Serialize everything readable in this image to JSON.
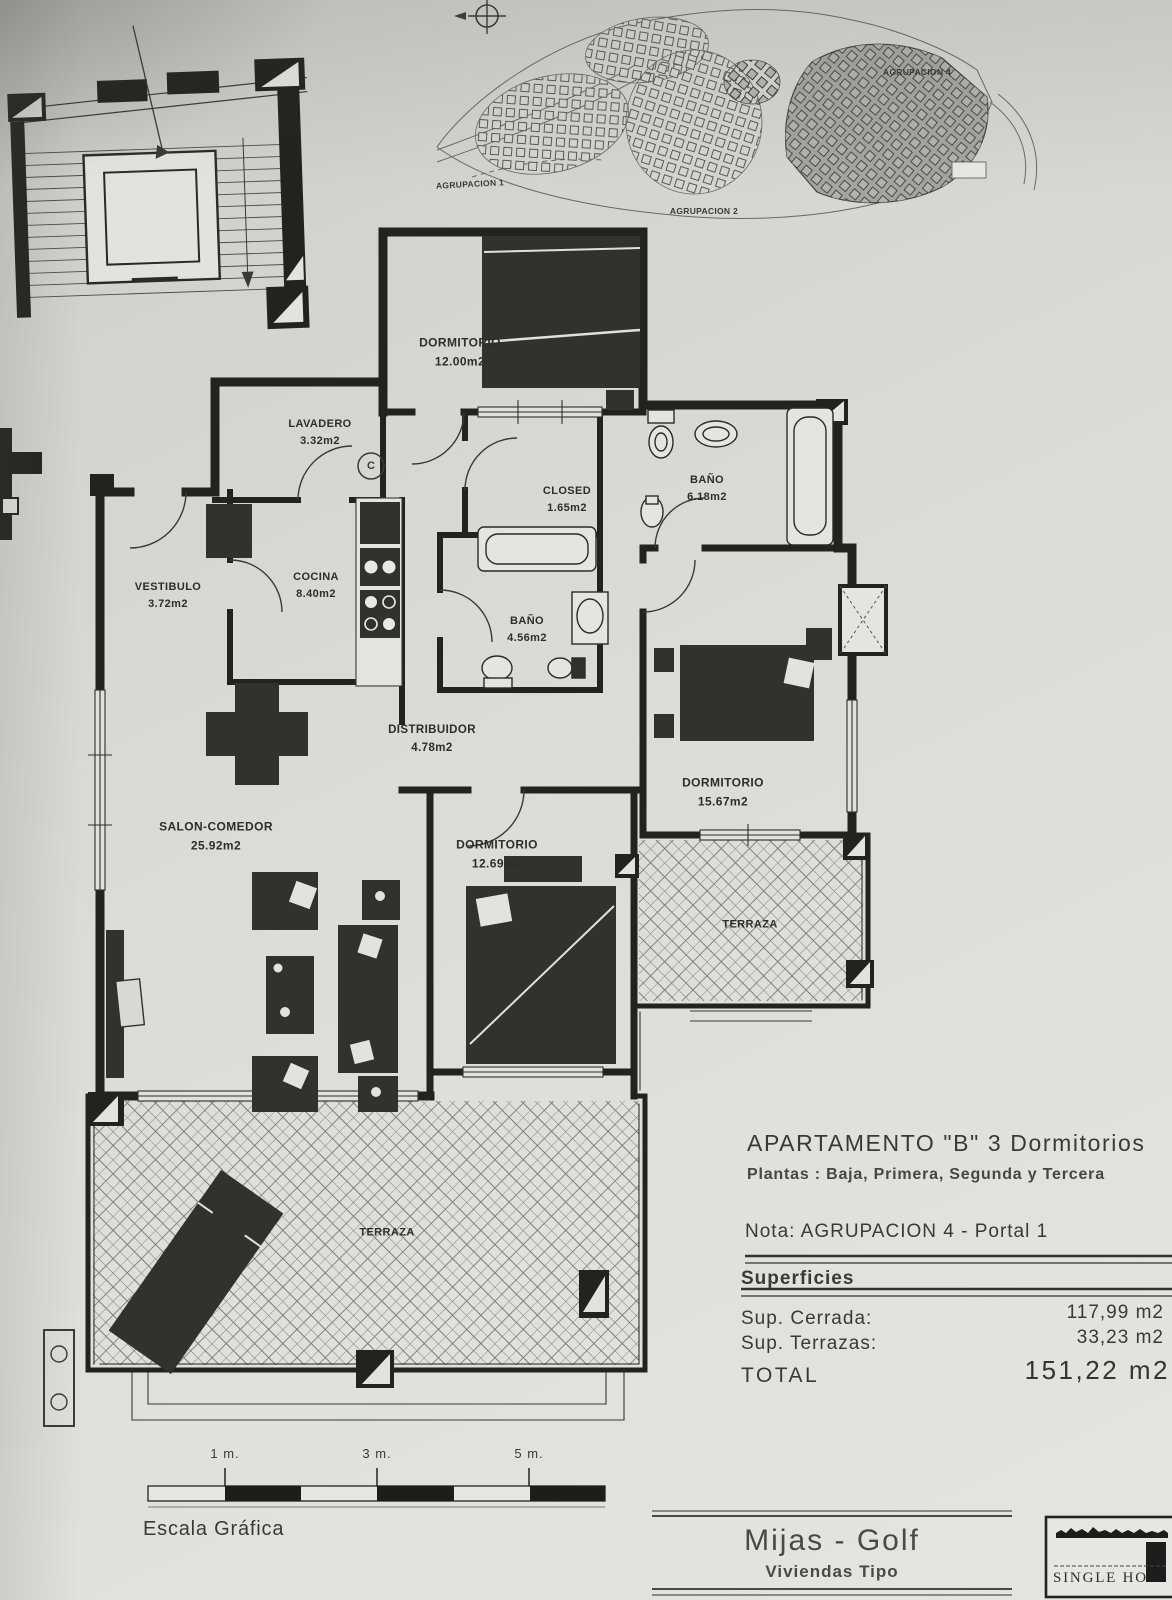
{
  "site_plan": {
    "agrupacion_labels": [
      "AGRUPACION 1",
      "AGRUPACION 2",
      "AGRUPACION 4"
    ]
  },
  "rooms": [
    {
      "name": "DORMITORIO",
      "area": "12.00m2"
    },
    {
      "name": "LAVADERO",
      "area": "3.32m2"
    },
    {
      "name": "CLOSED",
      "area": "1.65m2"
    },
    {
      "name": "BAÑO",
      "area": "6.18m2"
    },
    {
      "name": "VESTIBULO",
      "area": "3.72m2"
    },
    {
      "name": "COCINA",
      "area": "8.40m2"
    },
    {
      "name": "BAÑO",
      "area": "4.56m2"
    },
    {
      "name": "DISTRIBUIDOR",
      "area": "4.78m2"
    },
    {
      "name": "SALON-COMEDOR",
      "area": "25.92m2"
    },
    {
      "name": "DORMITORIO",
      "area": "12.69m2"
    },
    {
      "name": "DORMITORIO",
      "area": "15.67m2"
    },
    {
      "name": "TERRAZA",
      "area": ""
    },
    {
      "name": "TERRAZA",
      "area": ""
    }
  ],
  "symbols": {
    "boiler": "C"
  },
  "info_panel": {
    "title": "APARTAMENTO \"B\" 3 Dormitorios",
    "plantas_line": "Plantas :  Baja, Primera, Segunda y Tercera",
    "nota_line": "Nota: AGRUPACION 4  - Portal 1",
    "superficies_heading": "Superficies",
    "sup_cerrada_label": "Sup. Cerrada:",
    "sup_cerrada_value": "117,99 m2",
    "sup_terrazas_label": "Sup. Terrazas:",
    "sup_terrazas_value": "33,23 m2",
    "total_label": "TOTAL",
    "total_value": "151,22 m2"
  },
  "scale_bar": {
    "tick_labels": [
      "1 m.",
      "3 m.",
      "5 m."
    ],
    "caption": "Escala Gráfica"
  },
  "title_block": {
    "project": "Mijas - Golf",
    "subtitle": "Viviendas Tipo",
    "logo_text": "SINGLE HO"
  }
}
